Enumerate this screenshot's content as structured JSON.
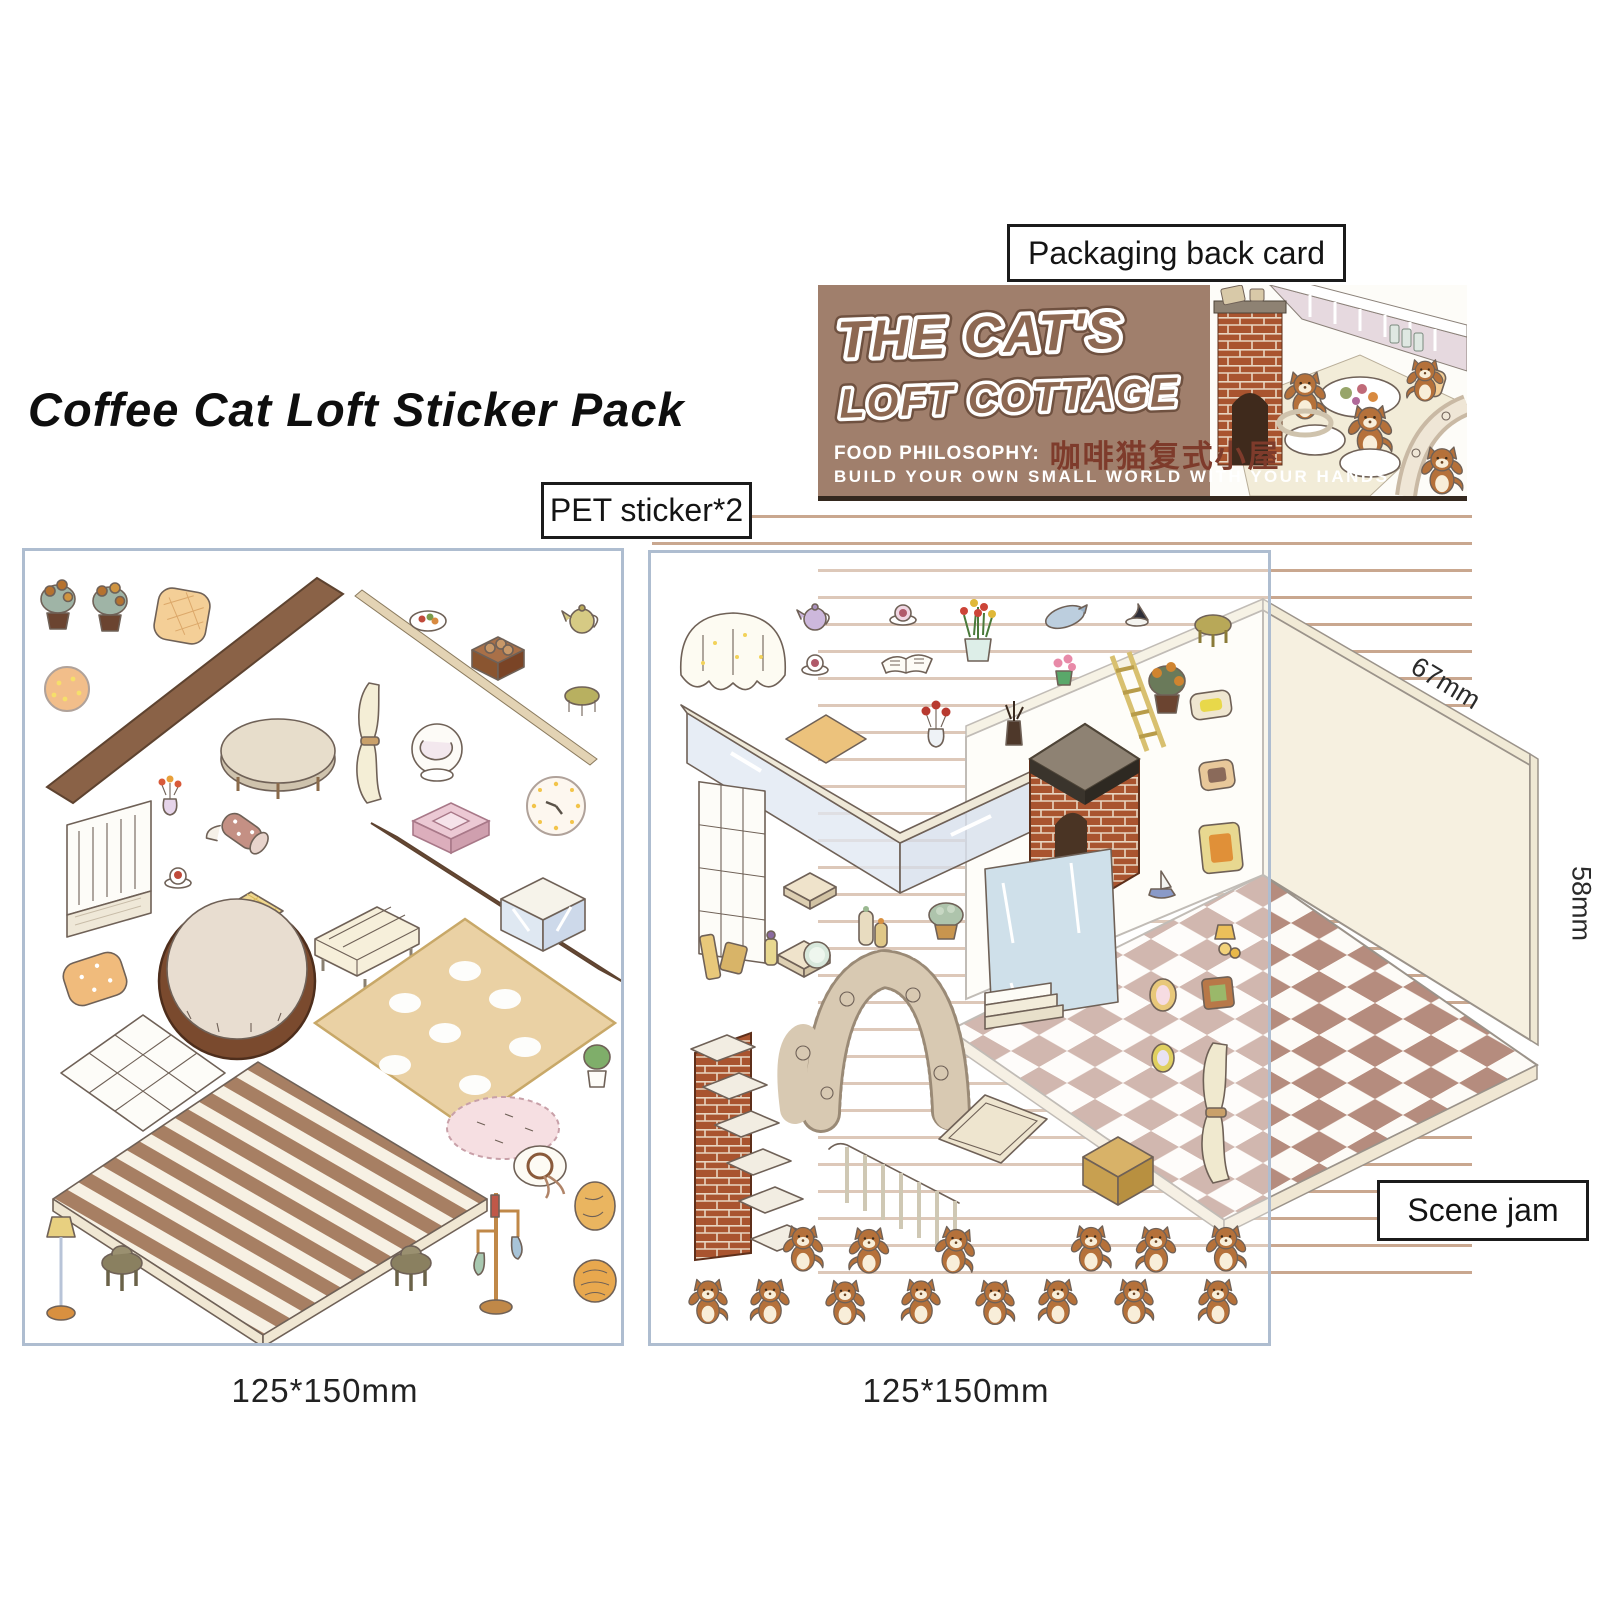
{
  "title": "Coffee Cat Loft Sticker Pack",
  "callouts": {
    "packaging_back_card": "Packaging back card",
    "pet_sticker": "PET sticker*2",
    "scene_jam": "Scene jam"
  },
  "packaging_card": {
    "title_line1": "THE CAT'S",
    "title_line2": "LOFT COTTAGE",
    "food_philosophy_label": "FOOD PHILOSOPHY:",
    "chinese_name": "咖啡猫复式小屋",
    "tagline": "BUILD YOUR OWN SMALL WORLD WITH YOUR HANDS",
    "bg_color": "#a07f6c",
    "title_fill": "#8d6852",
    "title_outline": "#ffffff",
    "chinese_color": "#7e3b2b"
  },
  "dimensions": {
    "sheet_left_size": "125*150mm",
    "sheet_right_size": "125*150mm",
    "scene_top_edge": "67mm",
    "scene_side_edge": "58mm"
  },
  "sheets": {
    "left": {
      "type": "PET sticker sheet",
      "items": [
        "potted-plant",
        "potted-plant",
        "waffle-cushion",
        "brown-wall-panel",
        "wooden-beam",
        "fruit-plate",
        "log-crate",
        "teapot",
        "wooden-stool",
        "round-dotted-rug",
        "oval-table",
        "curtain",
        "laundry-chair",
        "wall-clock",
        "pink-step-shelf",
        "tulip-vase",
        "fabric-roller",
        "brown-wall-panel",
        "teacup",
        "teacup",
        "plaid-cushion",
        "cream-sofa",
        "glass-counter",
        "baby-fence",
        "pet-bed",
        "dotted-cushion",
        "tufted-mat",
        "flower-rug",
        "potted-plant",
        "oval-rug",
        "striped-wood-floor",
        "floor-lamp",
        "stool",
        "stool",
        "coat-rack",
        "straw-hat",
        "cookie",
        "bread-bun"
      ]
    },
    "right": {
      "type": "PET sticker sheet",
      "items": [
        "tablecloth-table",
        "teapot",
        "teacup",
        "tulip-pot",
        "fish-plate",
        "witch-hat",
        "wooden-stool",
        "teacup",
        "open-book",
        "flower-pot",
        "sunflower-pot",
        "rose-vase",
        "twig-bottle",
        "ladder",
        "glass-railing",
        "floor-mat",
        "window-frame",
        "seat-cushion",
        "seat-cushion",
        "candle-jars",
        "succulent-pot",
        "brick-fireplace",
        "picture-frame",
        "picture-frame",
        "picture-frame",
        "wall-lamp",
        "sailboat-ornament",
        "window-with-steps",
        "leaning-books",
        "perfume-bottle",
        "hand-mirror",
        "plush-arch",
        "brick-staircase",
        "stair-railing",
        "serving-tray",
        "ottoman-box",
        "tied-curtain",
        "oval-frame",
        "square-frame",
        "oval-frame"
      ],
      "cat_sticker_rows": [
        6,
        8
      ]
    }
  },
  "scene": {
    "description": "isometric room backdrop with checkerboard floor",
    "floor_tile_brown": "#b58c7e",
    "floor_tile_white": "#fdfbf7",
    "wall_left_color": "#fefcf6",
    "wall_right_color": "#f6f0e0",
    "stripe_color": "#c9a78f"
  }
}
